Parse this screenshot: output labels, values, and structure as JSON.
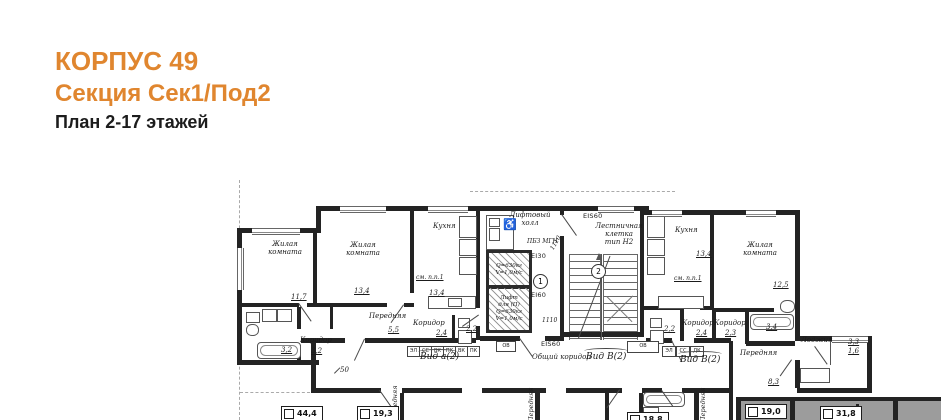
{
  "header": {
    "building": "КОРПУС 49",
    "section": "Секция Сек1/Под2",
    "floors": "План 2-17 этажей"
  },
  "palette": {
    "accent": "#E0862F",
    "wall": "#232323",
    "highlight": "#9C9C9C"
  },
  "icons": {
    "mgn": "♿"
  },
  "plan": {
    "rooms": {
      "living1": {
        "name": "Жилая комната",
        "area": "11,7"
      },
      "living2": {
        "name": "Жилая комната",
        "area": "13,4"
      },
      "kitchen_left": {
        "name": "Кухня",
        "note": "см. п.п.1",
        "area": "13,4"
      },
      "hall_left": {
        "name": "Передняя",
        "area": "5,5"
      },
      "corridor_left": {
        "name": "Коридор",
        "area": "3,2"
      },
      "bath_left": {
        "area": "3,2"
      },
      "corridor_mid": {
        "name": "Коридор",
        "area": "2,4"
      },
      "bath_mid": {
        "area": "2,2"
      },
      "kitchen_right": {
        "name": "Кухня",
        "note": "см. п.п.1",
        "area": "13,4"
      },
      "living_right": {
        "name": "Жилая комната",
        "area": "12,5"
      },
      "corridor_r1": {
        "name": "Коридор",
        "area": "2,4"
      },
      "corridor_r2": {
        "name": "Коридор",
        "area": "2,3"
      },
      "bath_r1": {
        "area": "2,2"
      },
      "bath_r2": {
        "area": "3,4"
      },
      "loggia": {
        "name": "Лоджия",
        "area_top": "3,3",
        "area_bottom": "1,6"
      },
      "hall_right": {
        "name": "Передняя",
        "area": "8,3"
      },
      "vestibule": "Передняя"
    },
    "core": {
      "lift_hall": "Лифтовый\nхолл",
      "mgn_zone": "ПБЗ МГН",
      "lift1_specs": "Q=630кг\nV=1,0м/с",
      "lift2_specs": "Лифт\nдля (П)\nQ=630кг\nV=1,0м/с",
      "fire_ei30": "EI30",
      "fire_ei60": "EI60",
      "fire_eis60_door": "EIS60",
      "fire_eis60_top": "EIS60",
      "lift_num": "1",
      "stair_num": "2",
      "staircase": "Лестничная\nклетка\nтип Н2"
    },
    "corridor": {
      "label": "Общий коридор",
      "view_a": "Вид а(2)",
      "view_b_left": "Вид В(2)",
      "view_b_right": "Вид В(2)",
      "meters_left": [
        "ЭЛ",
        "СС",
        "ВК",
        "ПК",
        "ВК",
        "ПК"
      ],
      "meters_right": [
        "ЭЛ",
        "СС",
        "ДК"
      ],
      "ov_left": "ОВ",
      "ov_right": "ОВ"
    },
    "dims": {
      "door_stair": "1110",
      "door_core": "1110",
      "d50": "50"
    },
    "apartment_areas": [
      "44,4",
      "19,3",
      "18,8",
      "19,0",
      "31,8"
    ]
  }
}
